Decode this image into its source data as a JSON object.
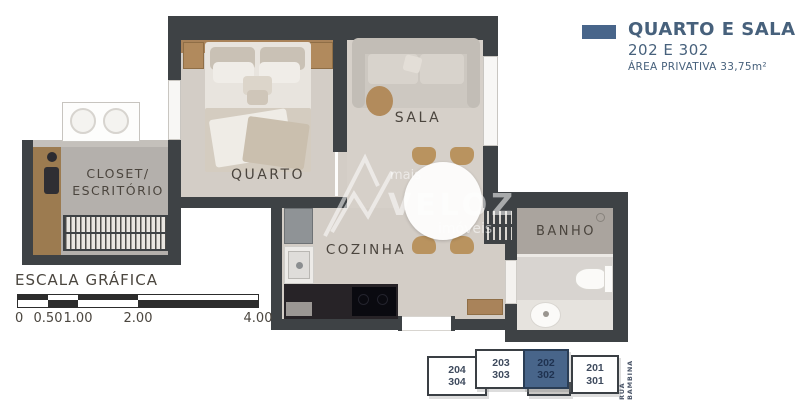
{
  "legend": {
    "title": "QUARTO E SALA",
    "units_line": "202 E 302",
    "area_line": "ÁREA PRIVATIVA 33,75m²",
    "swatch_color": "#48658a"
  },
  "rooms": {
    "quarto": "QUARTO",
    "sala": "SALA",
    "cozinha": "COZINHA",
    "banho": "BANHO",
    "closet_line1": "CLOSET/",
    "closet_line2": "ESCRITÓRIO"
  },
  "scale_bar": {
    "title": "ESCALA GRÁFICA",
    "labels": [
      "0",
      "0.50",
      "1.00",
      "2.00",
      "4.00"
    ]
  },
  "key_plan": {
    "street": "RUA BAMBINA",
    "units": [
      {
        "line1": "204",
        "line2": "304",
        "highlighted": false
      },
      {
        "line1": "203",
        "line2": "303",
        "highlighted": false
      },
      {
        "line1": "202",
        "line2": "302",
        "highlighted": true
      },
      {
        "line1": "201",
        "line2": "301",
        "highlighted": false
      }
    ],
    "highlight_color": "#48658a"
  },
  "watermark": {
    "prefix": "mais",
    "brand": "VELOZ",
    "suffix": "imóveis"
  },
  "colors": {
    "wall": "#3e4245",
    "accent_blue": "#48658a",
    "room_label_text": "#4b453e",
    "legend_text": "#47617c"
  }
}
